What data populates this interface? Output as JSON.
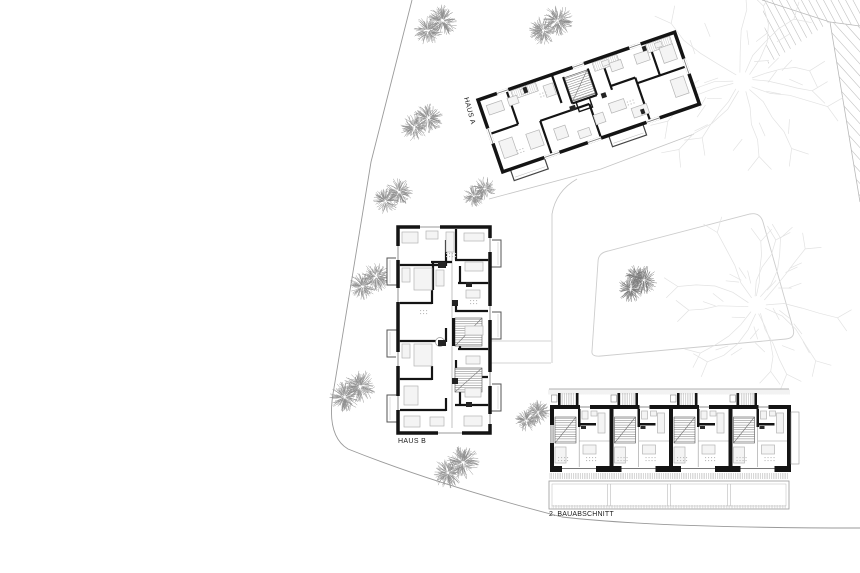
{
  "plan": {
    "buildings": {
      "haus_a": {
        "label": "HAUS A"
      },
      "haus_b": {
        "label": "HAUS B"
      },
      "row_houses": {
        "label": "2. BAUABSCHNITT",
        "unit_count": 4
      }
    },
    "colors": {
      "background": "#ffffff",
      "wall": "#141414",
      "thin_line": "#777777",
      "furniture_line": "#b4b4b4",
      "furniture_fill": "#f4f4f4",
      "stair_hatch": "#7a7a7a",
      "tick_hatch": "#b0b0b0",
      "path_line": "#c4c4c4",
      "boundary_line": "#9a9a9a",
      "roof_hatch": "#c2c2c2",
      "roof_edge": "#b9b9b9",
      "area_outline": "#cdcdcd",
      "tree_dark": "#8f8f8f",
      "tree_darker": "#7a7a7a",
      "tree_light": "#e2e2e2",
      "label_text": "#1a1a1a"
    },
    "trees": {
      "dark": [
        {
          "x": 435,
          "y": 25,
          "r": 20
        },
        {
          "x": 550,
          "y": 25,
          "r": 20
        },
        {
          "x": 421,
          "y": 122,
          "r": 19
        },
        {
          "x": 479,
          "y": 192,
          "r": 15
        },
        {
          "x": 392,
          "y": 196,
          "r": 18
        },
        {
          "x": 369,
          "y": 281,
          "r": 19
        },
        {
          "x": 352,
          "y": 391,
          "r": 21
        },
        {
          "x": 455,
          "y": 467,
          "r": 21
        },
        {
          "x": 532,
          "y": 416,
          "r": 16
        },
        {
          "x": 637,
          "y": 284,
          "r": 18,
          "dense": true
        }
      ],
      "light": [
        {
          "x": 743,
          "y": 82,
          "r": 82
        },
        {
          "x": 757,
          "y": 305,
          "r": 74
        }
      ]
    }
  }
}
